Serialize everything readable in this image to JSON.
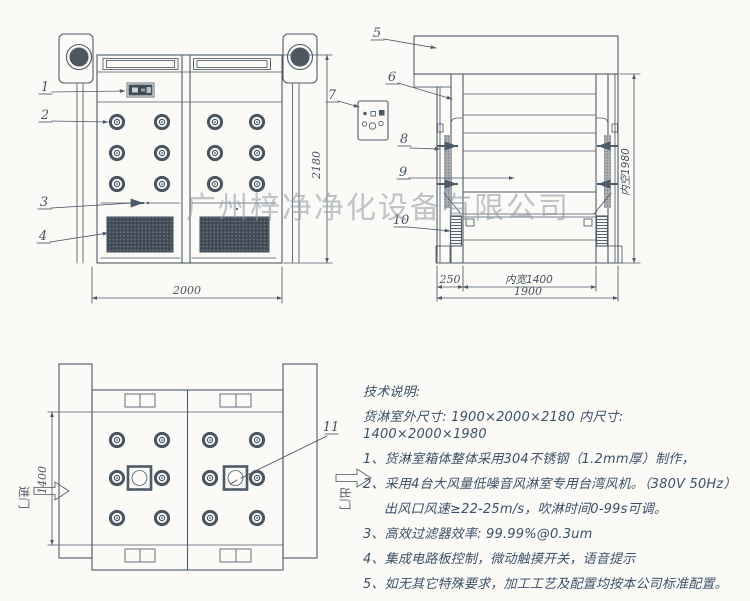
{
  "watermark": "广州梓净净化设备有限公司",
  "front_view": {
    "dim_width": "2000",
    "dim_height": "2180",
    "callout_1": "1",
    "callout_2": "2",
    "callout_3": "3",
    "callout_4": "4"
  },
  "side_view": {
    "dim_wall_depth": "250",
    "dim_inner_width": "内宽1400",
    "dim_total_depth": "1900",
    "dim_inner_height": "内空1980",
    "callout_5": "5",
    "callout_6": "6",
    "callout_7": "7",
    "callout_8": "8",
    "callout_9": "9",
    "callout_10": "10"
  },
  "plan_view": {
    "dim_inner_depth": "1400",
    "entry_label": "进门",
    "exit_label": "出门",
    "callout_11": "11"
  },
  "tech_notes": {
    "title": "技术说明:",
    "dimensions_line": "货淋室外尺寸: 1900×2000×2180  内尺寸: 1400×2000×1980",
    "items": [
      "1、货淋室箱体整体采用304不锈钢（1.2mm厚）制作，",
      "2、采用4台大风量低噪音风淋室专用台湾风机。（380V 50Hz）",
      "出风口风速≥22-25m/s，吹淋时间0-99s可调。",
      "3、高效过滤器效率: 99.99%@0.3um",
      "4、集成电路板控制，微动触摸开关，语音提示",
      "5、如无其它特殊要求，加工工艺及配置均按本公司标准配置。"
    ]
  }
}
